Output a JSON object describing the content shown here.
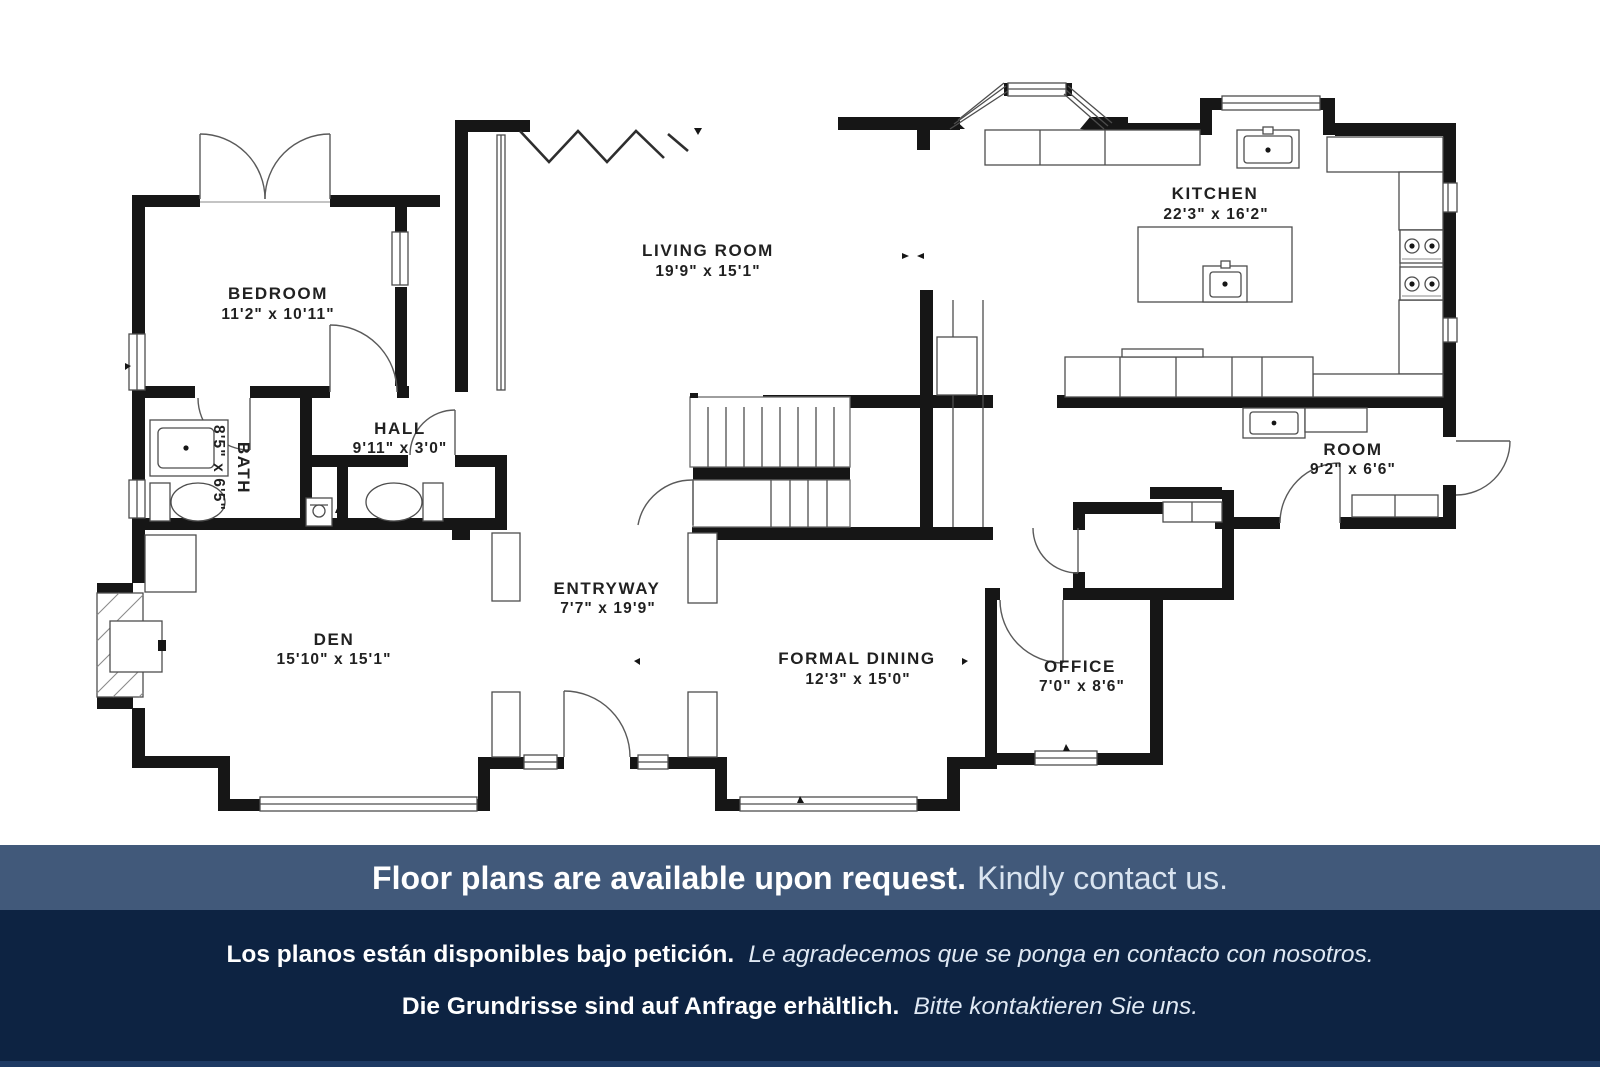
{
  "plan": {
    "rooms": [
      {
        "id": "bedroom",
        "name": "BEDROOM",
        "dims": "11'2\" x 10'11\""
      },
      {
        "id": "hall",
        "name": "HALL",
        "dims": "9'11\" x 3'0\""
      },
      {
        "id": "bath",
        "name": "BATH",
        "dims": "8'5\" x 6'5\""
      },
      {
        "id": "living-room",
        "name": "LIVING ROOM",
        "dims": "19'9\" x 15'1\""
      },
      {
        "id": "kitchen",
        "name": "KITCHEN",
        "dims": "22'3\" x 16'2\""
      },
      {
        "id": "room",
        "name": "ROOM",
        "dims": "9'2\" x 6'6\""
      },
      {
        "id": "entryway",
        "name": "ENTRYWAY",
        "dims": "7'7\" x 19'9\""
      },
      {
        "id": "den",
        "name": "DEN",
        "dims": "15'10\" x 15'1\""
      },
      {
        "id": "formal-dining",
        "name": "FORMAL DINING",
        "dims": "12'3\" x 15'0\""
      },
      {
        "id": "office",
        "name": "OFFICE",
        "dims": "7'0\" x 8'6\""
      }
    ]
  },
  "banner": {
    "bold": "Floor plans are available upon request.",
    "regular": "Kindly contact us.",
    "background": "#41597A"
  },
  "footer": {
    "background": "#0D2342",
    "spanish": {
      "bold": "Los planos están disponibles bajo petición.",
      "italic": "Le agradecemos que se ponga en contacto con nosotros."
    },
    "german": {
      "bold": "Die Grundrisse sind auf Anfrage erhältlich.",
      "italic": "Bitte kontaktieren Sie uns."
    }
  },
  "colors": {
    "wall": "#161616",
    "thin_line": "#4d4d4d",
    "plan_background": "#FFFFFF",
    "banner_background": "#41597A",
    "footer_background": "#0D2342"
  }
}
